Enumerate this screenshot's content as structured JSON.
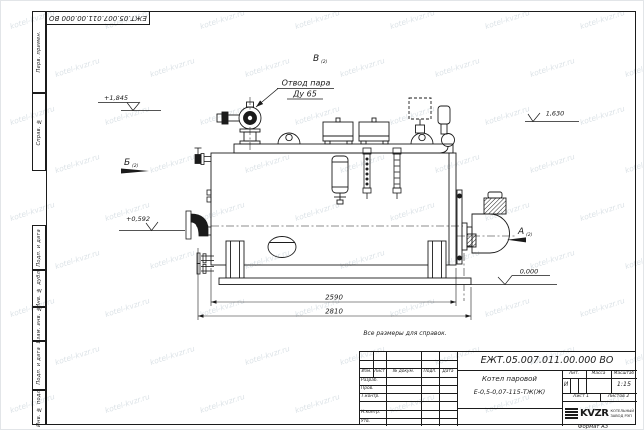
{
  "watermark": {
    "text": "kotel-kvzr.ru"
  },
  "margin": {
    "cells": [
      "Перв. примен.",
      "Справ. №",
      "Подп. и дата",
      "Инв. № дубл.",
      "Взам. инв. №",
      "Подп. и дата",
      "Инв. № подл."
    ]
  },
  "title_block": {
    "doc_number": "ЕЖТ.05.007.011.00.000  ВО",
    "name_line1": "Котел паровой",
    "name_line2": "Е-0,5-0,07-115-ТЖ(Ж)",
    "cols": [
      "Изм.",
      "Лист",
      "№ докум.",
      "Подп.",
      "Дата"
    ],
    "sign_rows": [
      "Разраб.",
      "Пров.",
      "Т.контр.",
      "Н.контр.",
      "Утв."
    ],
    "lit_label": "Лит.",
    "lit_value": "И",
    "mass_label": "Масса",
    "scale_label": "Масштаб",
    "scale_value": "1:15",
    "sheet": "Лист 1",
    "sheets": "Листов 2",
    "company": {
      "logo": "KVZR",
      "line1": "КОТЕЛЬНЫЙ",
      "line2": "ЗАВОД РЭП"
    },
    "format": "Формат А3"
  },
  "drawing": {
    "callout": {
      "line1": "Отвод пара",
      "line2": "Ду 65"
    },
    "note": "Все размеры для справок.",
    "dim_shell": "2590",
    "dim_overall": "2810",
    "elev_steam": "+1,845",
    "elev_top": "1,630",
    "elev_feed": "+0,592",
    "elev_base": "0,000",
    "view_a": "А",
    "view_b": "Б",
    "view_v": "В",
    "view_ref": "(2)"
  }
}
